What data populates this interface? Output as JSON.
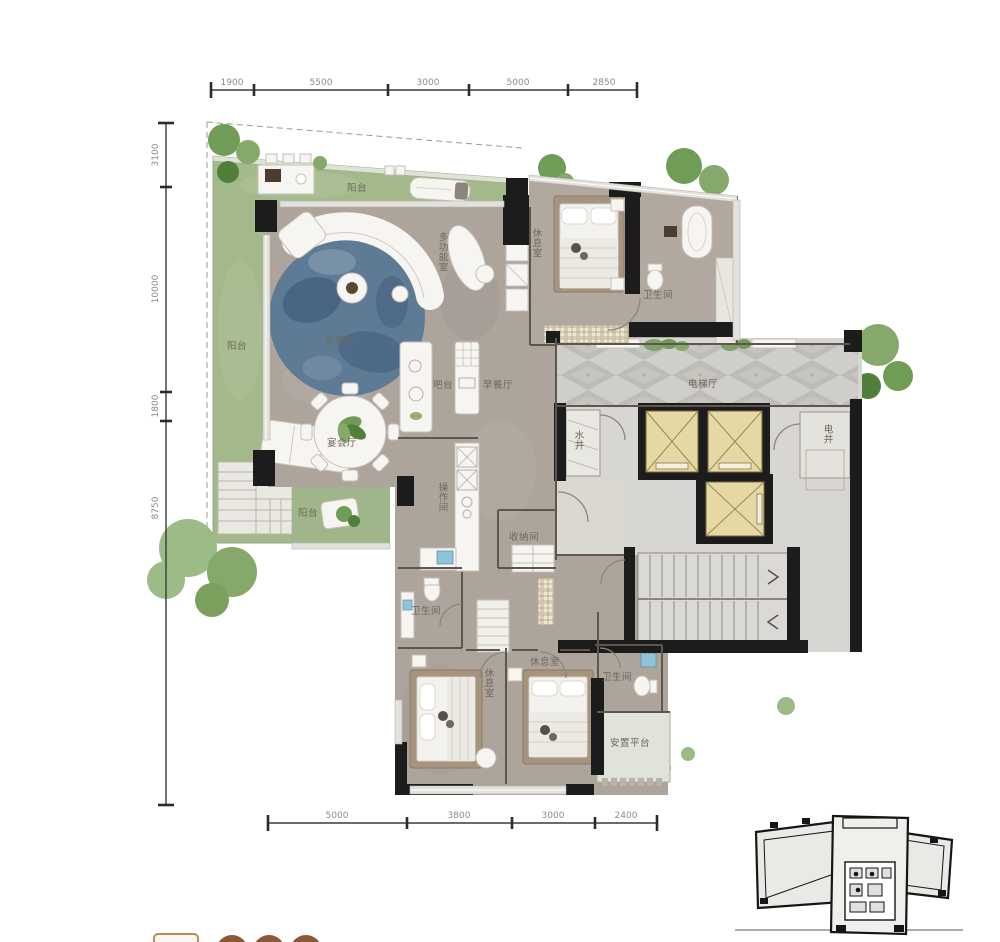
{
  "dimensions": {
    "top": [
      "1900",
      "5500",
      "3000",
      "5000",
      "2850"
    ],
    "left": [
      "3100",
      "10000",
      "1800",
      "8750"
    ],
    "bottom": [
      "5000",
      "3800",
      "3000",
      "2400"
    ]
  },
  "labels": {
    "terrace_top": "阳台",
    "terrace_left": "阳台",
    "balcony_bottom": "阳台",
    "reception": "会客厅",
    "banquet": "宴会厅",
    "multifunction": "多功能室",
    "bar": "吧台",
    "breakfast": "早餐厅",
    "lounge_top": "休息室",
    "bath_top": "卫生间",
    "elevator_hall": "电梯厅",
    "electric_shaft": "电井",
    "water_shaft": "水井",
    "kitchen": "操作间",
    "storage": "收纳间",
    "bath_mid": "卫生间",
    "lounge_left": "休息室",
    "lounge_right": "休息室",
    "bath_bottom": "卫生间",
    "ac_platform": "安置平台"
  },
  "colors": {
    "wall": "#1c1c1c",
    "floor": "#ada49c",
    "core_floor": "#d7d6d2",
    "garden": "#a3b98c",
    "rug_blue": "#5e7b95",
    "elevator_cab": "#e6d8a5",
    "caption_brown": "#8a5a38"
  }
}
